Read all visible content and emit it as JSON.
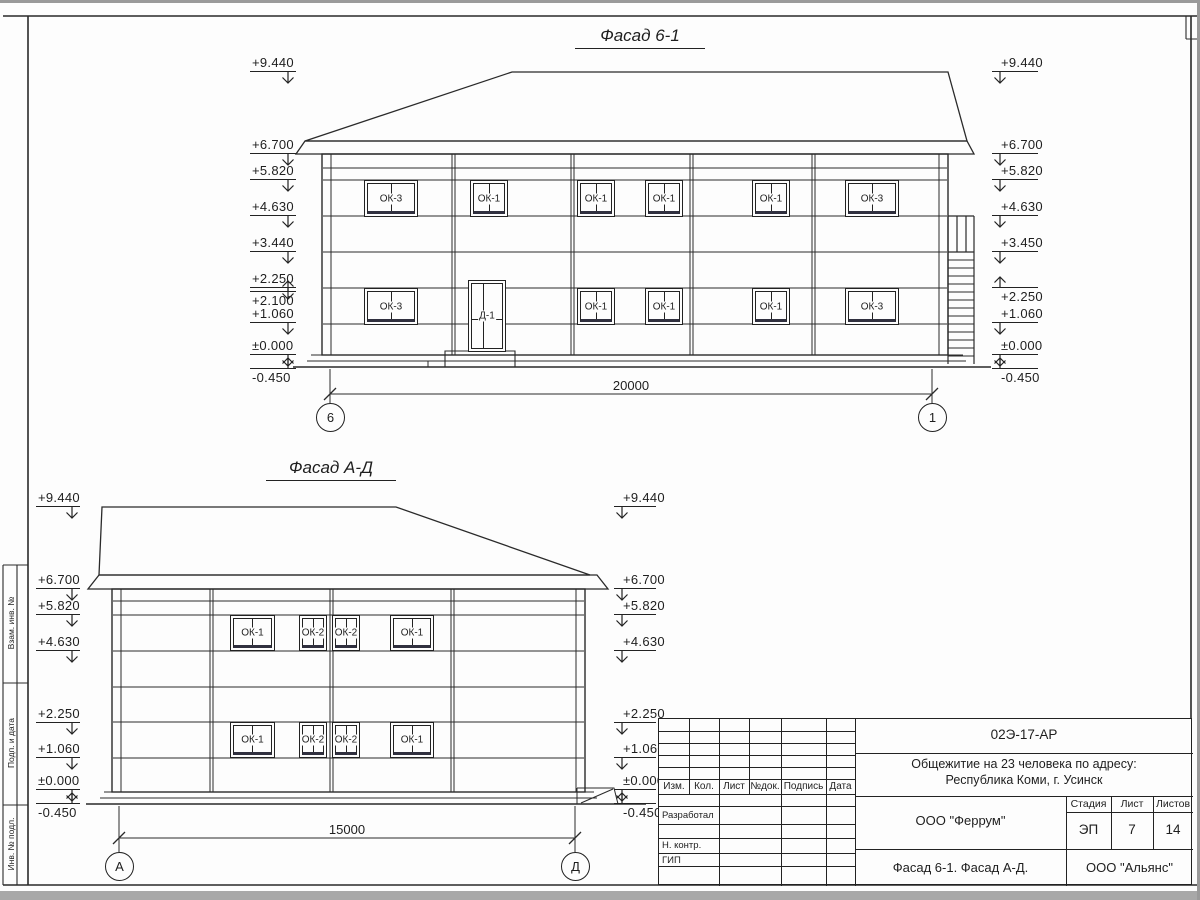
{
  "facade1": {
    "title": "Фасад 6-1",
    "dimension": "20000",
    "axis_left": "6",
    "axis_right": "1",
    "door_label": "Д-1",
    "windows_upper": [
      "ОК-3",
      "ОК-1",
      "ОК-1",
      "ОК-1",
      "ОК-1",
      "ОК-3"
    ],
    "windows_lower": [
      "ОК-3",
      "ОК-1",
      "ОК-1",
      "ОК-1",
      "ОК-3"
    ],
    "marks_left": [
      {
        "label": "+9.440",
        "dir": "down"
      },
      {
        "label": "+6.700",
        "dir": "down"
      },
      {
        "label": "+5.820",
        "dir": "down"
      },
      {
        "label": "+4.630",
        "dir": "down"
      },
      {
        "label": "+3.440",
        "dir": "down"
      },
      {
        "label": "+2.250",
        "dir": "down"
      },
      {
        "label": "+2.100",
        "dir": "up"
      },
      {
        "label": "+1.060",
        "dir": "down"
      },
      {
        "label": "±0.000",
        "dir": "down"
      },
      {
        "label": "-0.450",
        "dir": "up"
      }
    ],
    "marks_right": [
      {
        "label": "+9.440",
        "dir": "down"
      },
      {
        "label": "+6.700",
        "dir": "down"
      },
      {
        "label": "+5.820",
        "dir": "down"
      },
      {
        "label": "+4.630",
        "dir": "down"
      },
      {
        "label": "+3.450",
        "dir": "down"
      },
      {
        "label": "+2.250",
        "dir": "up"
      },
      {
        "label": "+1.060",
        "dir": "down"
      },
      {
        "label": "±0.000",
        "dir": "down"
      },
      {
        "label": "-0.450",
        "dir": "up"
      }
    ]
  },
  "facade2": {
    "title": "Фасад А-Д",
    "dimension": "15000",
    "axis_left": "А",
    "axis_right": "Д",
    "windows_upper": [
      "ОК-1",
      "ОК-2",
      "ОК-2",
      "ОК-1"
    ],
    "windows_lower": [
      "ОК-1",
      "ОК-2",
      "ОК-2",
      "ОК-1"
    ],
    "marks_left": [
      {
        "label": "+9.440",
        "dir": "down"
      },
      {
        "label": "+6.700",
        "dir": "down"
      },
      {
        "label": "+5.820",
        "dir": "down"
      },
      {
        "label": "+4.630",
        "dir": "down"
      },
      {
        "label": "+2.250",
        "dir": "down"
      },
      {
        "label": "+1.060",
        "dir": "down"
      },
      {
        "label": "±0.000",
        "dir": "down"
      },
      {
        "label": "-0.450",
        "dir": "up"
      }
    ],
    "marks_right": [
      {
        "label": "+9.440",
        "dir": "down"
      },
      {
        "label": "+6.700",
        "dir": "down"
      },
      {
        "label": "+5.820",
        "dir": "down"
      },
      {
        "label": "+4.630",
        "dir": "down"
      },
      {
        "label": "+2.250",
        "dir": "down"
      },
      {
        "label": "+1.060",
        "dir": "down"
      },
      {
        "label": "±0.000",
        "dir": "down"
      },
      {
        "label": "-0.450",
        "dir": "up"
      }
    ]
  },
  "titleblock": {
    "doc_number": "02Э-17-АР",
    "project_line1": "Общежитие на 23 человека по адресу:",
    "project_line2": "Республика Коми, г. Усинск",
    "header_cols": [
      "Изм.",
      "Кол.",
      "Лист",
      "№док.",
      "Подпись",
      "Дата"
    ],
    "row_labels": [
      "Разработал",
      "Н. контр.",
      "ГИП"
    ],
    "company": "ООО \"Феррум\"",
    "stage_label": "Стадия",
    "sheet_label": "Лист",
    "sheets_label": "Листов",
    "stage": "ЭП",
    "sheet": "7",
    "sheets": "14",
    "sheet_title": "Фасад 6-1. Фасад  А-Д.",
    "contractor": "ООО \"Альянс\""
  },
  "margin_labels": [
    "Взам. инв. №",
    "Подп. и дата",
    "Инв. № подл."
  ]
}
